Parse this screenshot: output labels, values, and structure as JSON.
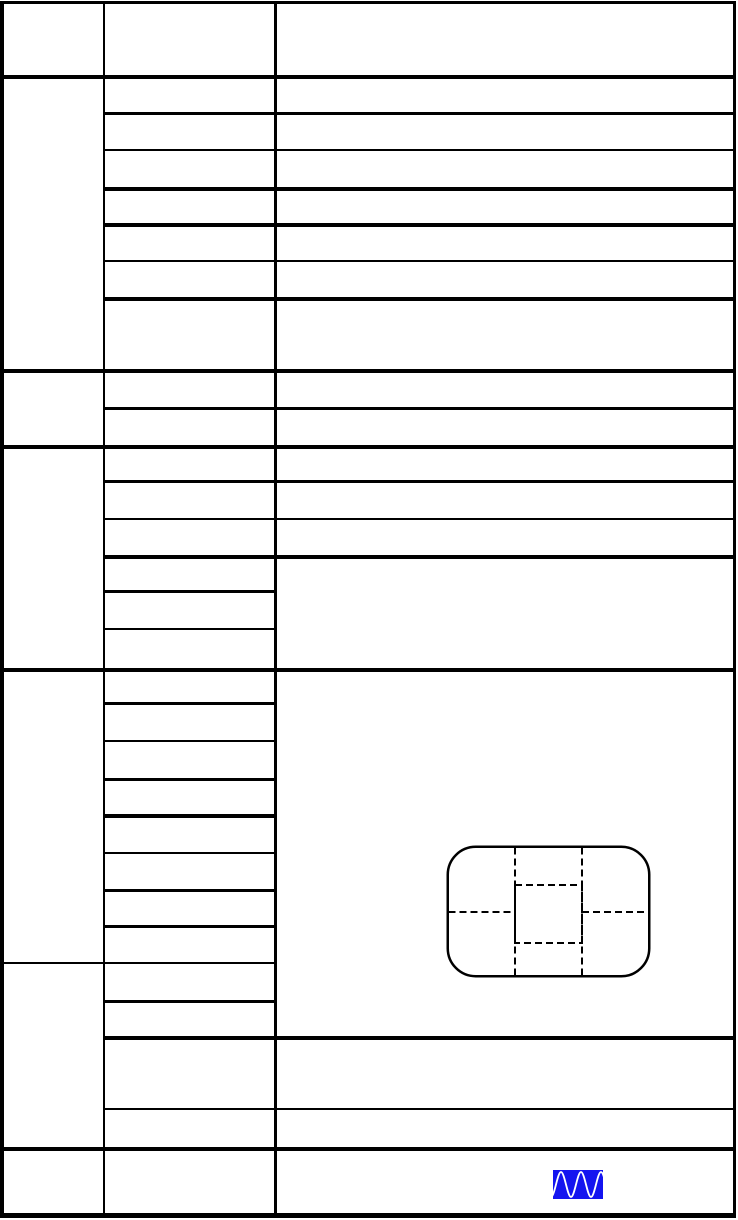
{
  "page": {
    "title": "manual-specification-table-page",
    "width_px": 738,
    "height_px": 1220,
    "background_color": "#ffffff",
    "grid_color": "#000000"
  },
  "table": {
    "columns_px": [
      0,
      103,
      274,
      736
    ],
    "v_lines": [
      {
        "x": 0,
        "y1": 1,
        "y2": 1218,
        "w": 4
      },
      {
        "x": 103,
        "y1": 1,
        "y2": 1218,
        "w": 2
      },
      {
        "x": 274,
        "y1": 1,
        "y2": 1218,
        "w": 3
      },
      {
        "x": 733,
        "y1": 1,
        "y2": 1218,
        "w": 3
      }
    ],
    "h_lines": [
      {
        "y": 1,
        "x1": 0,
        "x2": 736,
        "w": 3
      },
      {
        "y": 75,
        "x1": 0,
        "x2": 736,
        "w": 4
      },
      {
        "y": 112,
        "x1": 103,
        "x2": 736,
        "w": 3
      },
      {
        "y": 149,
        "x1": 103,
        "x2": 736,
        "w": 2
      },
      {
        "y": 187,
        "x1": 103,
        "x2": 736,
        "w": 4
      },
      {
        "y": 223,
        "x1": 103,
        "x2": 736,
        "w": 4
      },
      {
        "y": 260,
        "x1": 103,
        "x2": 736,
        "w": 2
      },
      {
        "y": 297,
        "x1": 103,
        "x2": 736,
        "w": 4
      },
      {
        "y": 369,
        "x1": 0,
        "x2": 736,
        "w": 4
      },
      {
        "y": 407,
        "x1": 103,
        "x2": 736,
        "w": 3
      },
      {
        "y": 445,
        "x1": 0,
        "x2": 736,
        "w": 4
      },
      {
        "y": 480,
        "x1": 103,
        "x2": 736,
        "w": 3
      },
      {
        "y": 518,
        "x1": 103,
        "x2": 736,
        "w": 2
      },
      {
        "y": 555,
        "x1": 103,
        "x2": 736,
        "w": 4
      },
      {
        "y": 590,
        "x1": 103,
        "x2": 277,
        "w": 3
      },
      {
        "y": 628,
        "x1": 103,
        "x2": 277,
        "w": 2
      },
      {
        "y": 668,
        "x1": 0,
        "x2": 736,
        "w": 4
      },
      {
        "y": 702,
        "x1": 103,
        "x2": 277,
        "w": 3
      },
      {
        "y": 740,
        "x1": 103,
        "x2": 277,
        "w": 2
      },
      {
        "y": 778,
        "x1": 103,
        "x2": 277,
        "w": 3
      },
      {
        "y": 814,
        "x1": 103,
        "x2": 277,
        "w": 4
      },
      {
        "y": 852,
        "x1": 103,
        "x2": 277,
        "w": 2
      },
      {
        "y": 889,
        "x1": 103,
        "x2": 277,
        "w": 3
      },
      {
        "y": 925,
        "x1": 103,
        "x2": 277,
        "w": 3
      },
      {
        "y": 962,
        "x1": 0,
        "x2": 277,
        "w": 2
      },
      {
        "y": 1000,
        "x1": 103,
        "x2": 277,
        "w": 3
      },
      {
        "y": 1036,
        "x1": 103,
        "x2": 736,
        "w": 4
      },
      {
        "y": 1108,
        "x1": 103,
        "x2": 736,
        "w": 2
      },
      {
        "y": 1147,
        "x1": 0,
        "x2": 736,
        "w": 4
      },
      {
        "y": 1213,
        "x1": 0,
        "x2": 736,
        "w": 5
      }
    ]
  },
  "metering_diagram": {
    "icon_name": "metering-area-diagram",
    "x": 446,
    "y": 845,
    "width": 205,
    "height": 133,
    "corner_radius": 28,
    "outline_color": "#000000",
    "outline_width": 2.5,
    "dash_color": "#000000",
    "dash_pattern": "7 4",
    "dash_width": 2,
    "v_lines_x": [
      69,
      136
    ],
    "center_box": {
      "x": 69,
      "y": 40,
      "width": 67,
      "height": 58
    },
    "mid_line_y": 67
  },
  "waveform_icon": {
    "icon_name": "sine-wave-icon",
    "x": 553,
    "y": 1170,
    "width": 50,
    "height": 29,
    "background_color": "#1414f0",
    "wave_color": "#ffffff",
    "wave_cycles": 2.5,
    "wave_stroke_width": 1.8
  }
}
